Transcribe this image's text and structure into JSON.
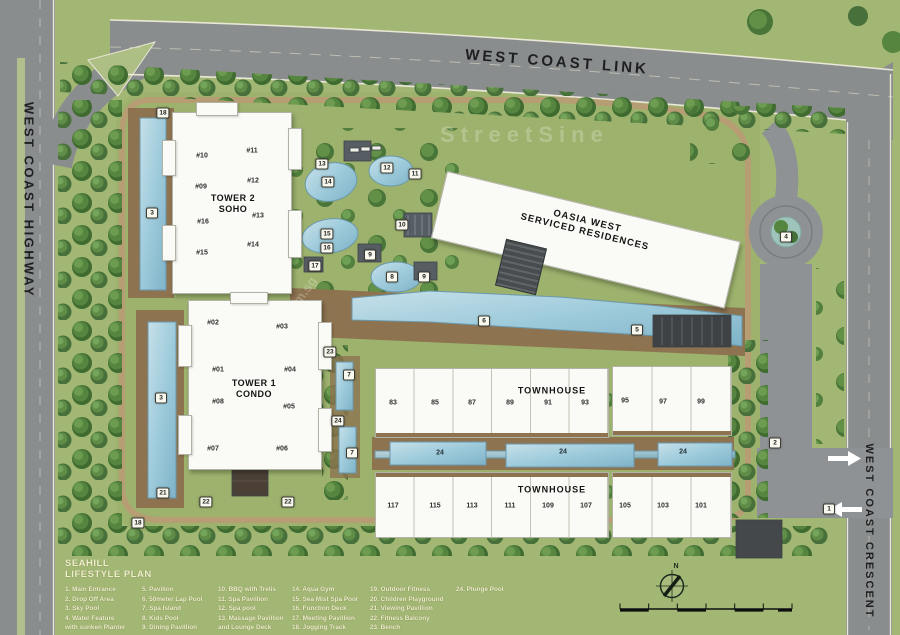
{
  "roads": {
    "top_label": "WEST COAST LINK",
    "left_label": "WEST COAST HIGHWAY",
    "right_label": "WEST COAST CRESCENT"
  },
  "buildings": {
    "oasia": {
      "line1": "OASIA WEST",
      "line2": "SERVICED RESIDENCES"
    },
    "tower2": {
      "line1": "TOWER 2",
      "line2": "SOHO",
      "units": [
        "#10",
        "#11",
        "#09",
        "#12",
        "#16",
        "#13",
        "#15",
        "#14"
      ]
    },
    "tower1": {
      "line1": "TOWER 1",
      "line2": "CONDO",
      "units": [
        "#02",
        "#03",
        "#01",
        "#04",
        "#08",
        "#05",
        "#07",
        "#06"
      ]
    },
    "townhouse_north": {
      "label": "TOWNHOUSE",
      "units": [
        "83",
        "85",
        "87",
        "89",
        "91",
        "93",
        "95",
        "97",
        "99"
      ]
    },
    "townhouse_south": {
      "label": "TOWNHOUSE",
      "units": [
        "117",
        "115",
        "113",
        "111",
        "109",
        "107",
        "105",
        "103",
        "101"
      ]
    }
  },
  "markers": [
    "18",
    "3",
    "13",
    "14",
    "12",
    "11",
    "10",
    "15",
    "16",
    "9",
    "17",
    "8",
    "9",
    "6",
    "5",
    "23",
    "7",
    "3",
    "24",
    "7",
    "2",
    "21",
    "22",
    "22",
    "1",
    "18",
    "4"
  ],
  "pool_labels": [
    "24",
    "24",
    "24"
  ],
  "legend": {
    "title": [
      "SEAHILL",
      "LIFESTYLE PLAN"
    ],
    "columns": [
      [
        "1. Main Entrance",
        "2. Drop Off Area",
        "3. Sky Pool",
        "4. Water Feature",
        "with sunken Planter"
      ],
      [
        "5. Pavilion",
        "6. 50meter Lap Pool",
        "7. Spa Island",
        "8. Kids Pool",
        "9. Dining Pavillion"
      ],
      [
        "10. BBQ with Trelis",
        "11. Spa Pavillion",
        "12. Spa pool",
        "13. Massage Pavillion",
        "and Lounge Deck"
      ],
      [
        "14. Aqua Gym",
        "15. Sea Mist Spa Pool",
        "16. Function Deck",
        "17. Meeting Pavillion",
        "18. Jogging Track"
      ],
      [
        "19. Outdoor Fitness",
        "20. Children Playground",
        "21. Viewing Pavillion",
        "22. Fitness Balcony",
        "23. Bench"
      ],
      [
        "24. Plunge Pool"
      ]
    ]
  },
  "compass": {
    "north": "N"
  },
  "watermarks": [
    "StreetSine",
    "srx.com.sg"
  ],
  "palette": {
    "grass": "#a3b774",
    "road": "#8a8d8e",
    "deck": "#8d7350",
    "pool": "#9ecbdb",
    "tree": "#4f7a39",
    "building": "#fafaf6",
    "legend_text": "#f1eecb"
  }
}
